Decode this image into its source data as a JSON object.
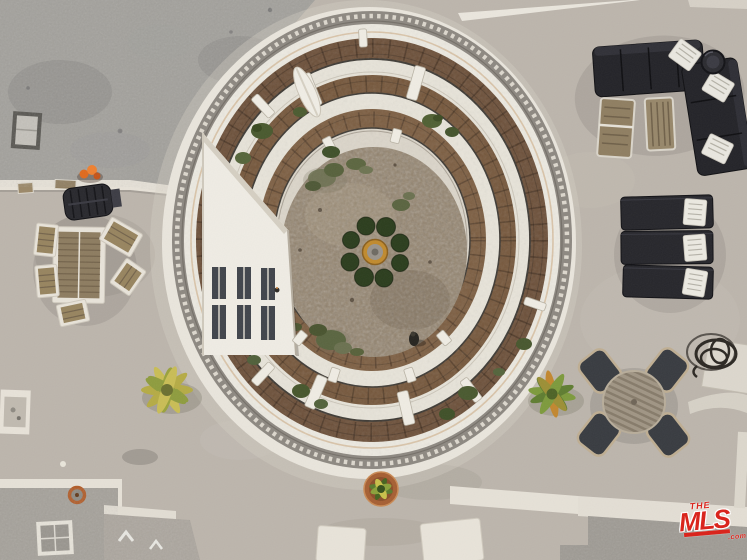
{
  "watermark": {
    "the": "THE",
    "mls": "MLS",
    "com": ".com",
    "color": "#d9251d"
  },
  "palette": {
    "deck": "#bcb5ac",
    "upper_roof": "#a2a09b",
    "white_trim": "#e9e5db",
    "brick_walkway": "#74553a",
    "courtyard_ground": "#93836d",
    "furniture_black": "#26262b",
    "wood": "#8d7c60",
    "terracotta_pot": "#a65f33",
    "palm_yellow": "#c3b94a",
    "palm_green": "#7f9a3b",
    "fountain_ring": "#c08a2e",
    "brand_red": "#d9251d"
  },
  "scene": {
    "objects": [
      {
        "name": "rooftop-deck",
        "label": "concrete rooftop deck"
      },
      {
        "name": "courtyard-atrium",
        "label": "oval interior courtyard atrium"
      },
      {
        "name": "balcony-tiers",
        "label": "tiered brick balcony walkways with white railings"
      },
      {
        "name": "balcony-columns",
        "label": "white columns around atrium"
      },
      {
        "name": "atrium-west-wall",
        "label": "white angled wall with windows"
      },
      {
        "name": "fountain",
        "label": "round fountain ringed by shrubs"
      },
      {
        "name": "umbrella",
        "label": "closed white patio umbrella"
      },
      {
        "name": "sectional-sofa",
        "label": "black L-shaped outdoor sectional with striped pillows"
      },
      {
        "name": "fire-table",
        "label": "round black fire table"
      },
      {
        "name": "wooden-chairs",
        "label": "two wood-slat chairs"
      },
      {
        "name": "sun-loungers",
        "label": "three black sun loungers with striped pillows"
      },
      {
        "name": "outdoor-dining-set",
        "label": "round slat-top table with four chairs"
      },
      {
        "name": "garden-hose",
        "label": "coiled dark garden hose"
      },
      {
        "name": "patio-dining-set-left",
        "label": "rectangular teak dining set"
      },
      {
        "name": "bbq-grill",
        "label": "black barbecue grill"
      },
      {
        "name": "skylight-upper-left",
        "label": "square rooftop skylight"
      },
      {
        "name": "skylight-lower-left",
        "label": "square rooftop skylight"
      },
      {
        "name": "roof-vents",
        "label": "roof vents and pipes"
      },
      {
        "name": "palm-tree-left",
        "label": "yellow-green palm crown"
      },
      {
        "name": "palm-tree-right",
        "label": "green palm crown"
      },
      {
        "name": "potted-plant",
        "label": "terracotta potted plant"
      },
      {
        "name": "mls-watermark",
        "label": "THE MLS.com watermark"
      }
    ]
  }
}
